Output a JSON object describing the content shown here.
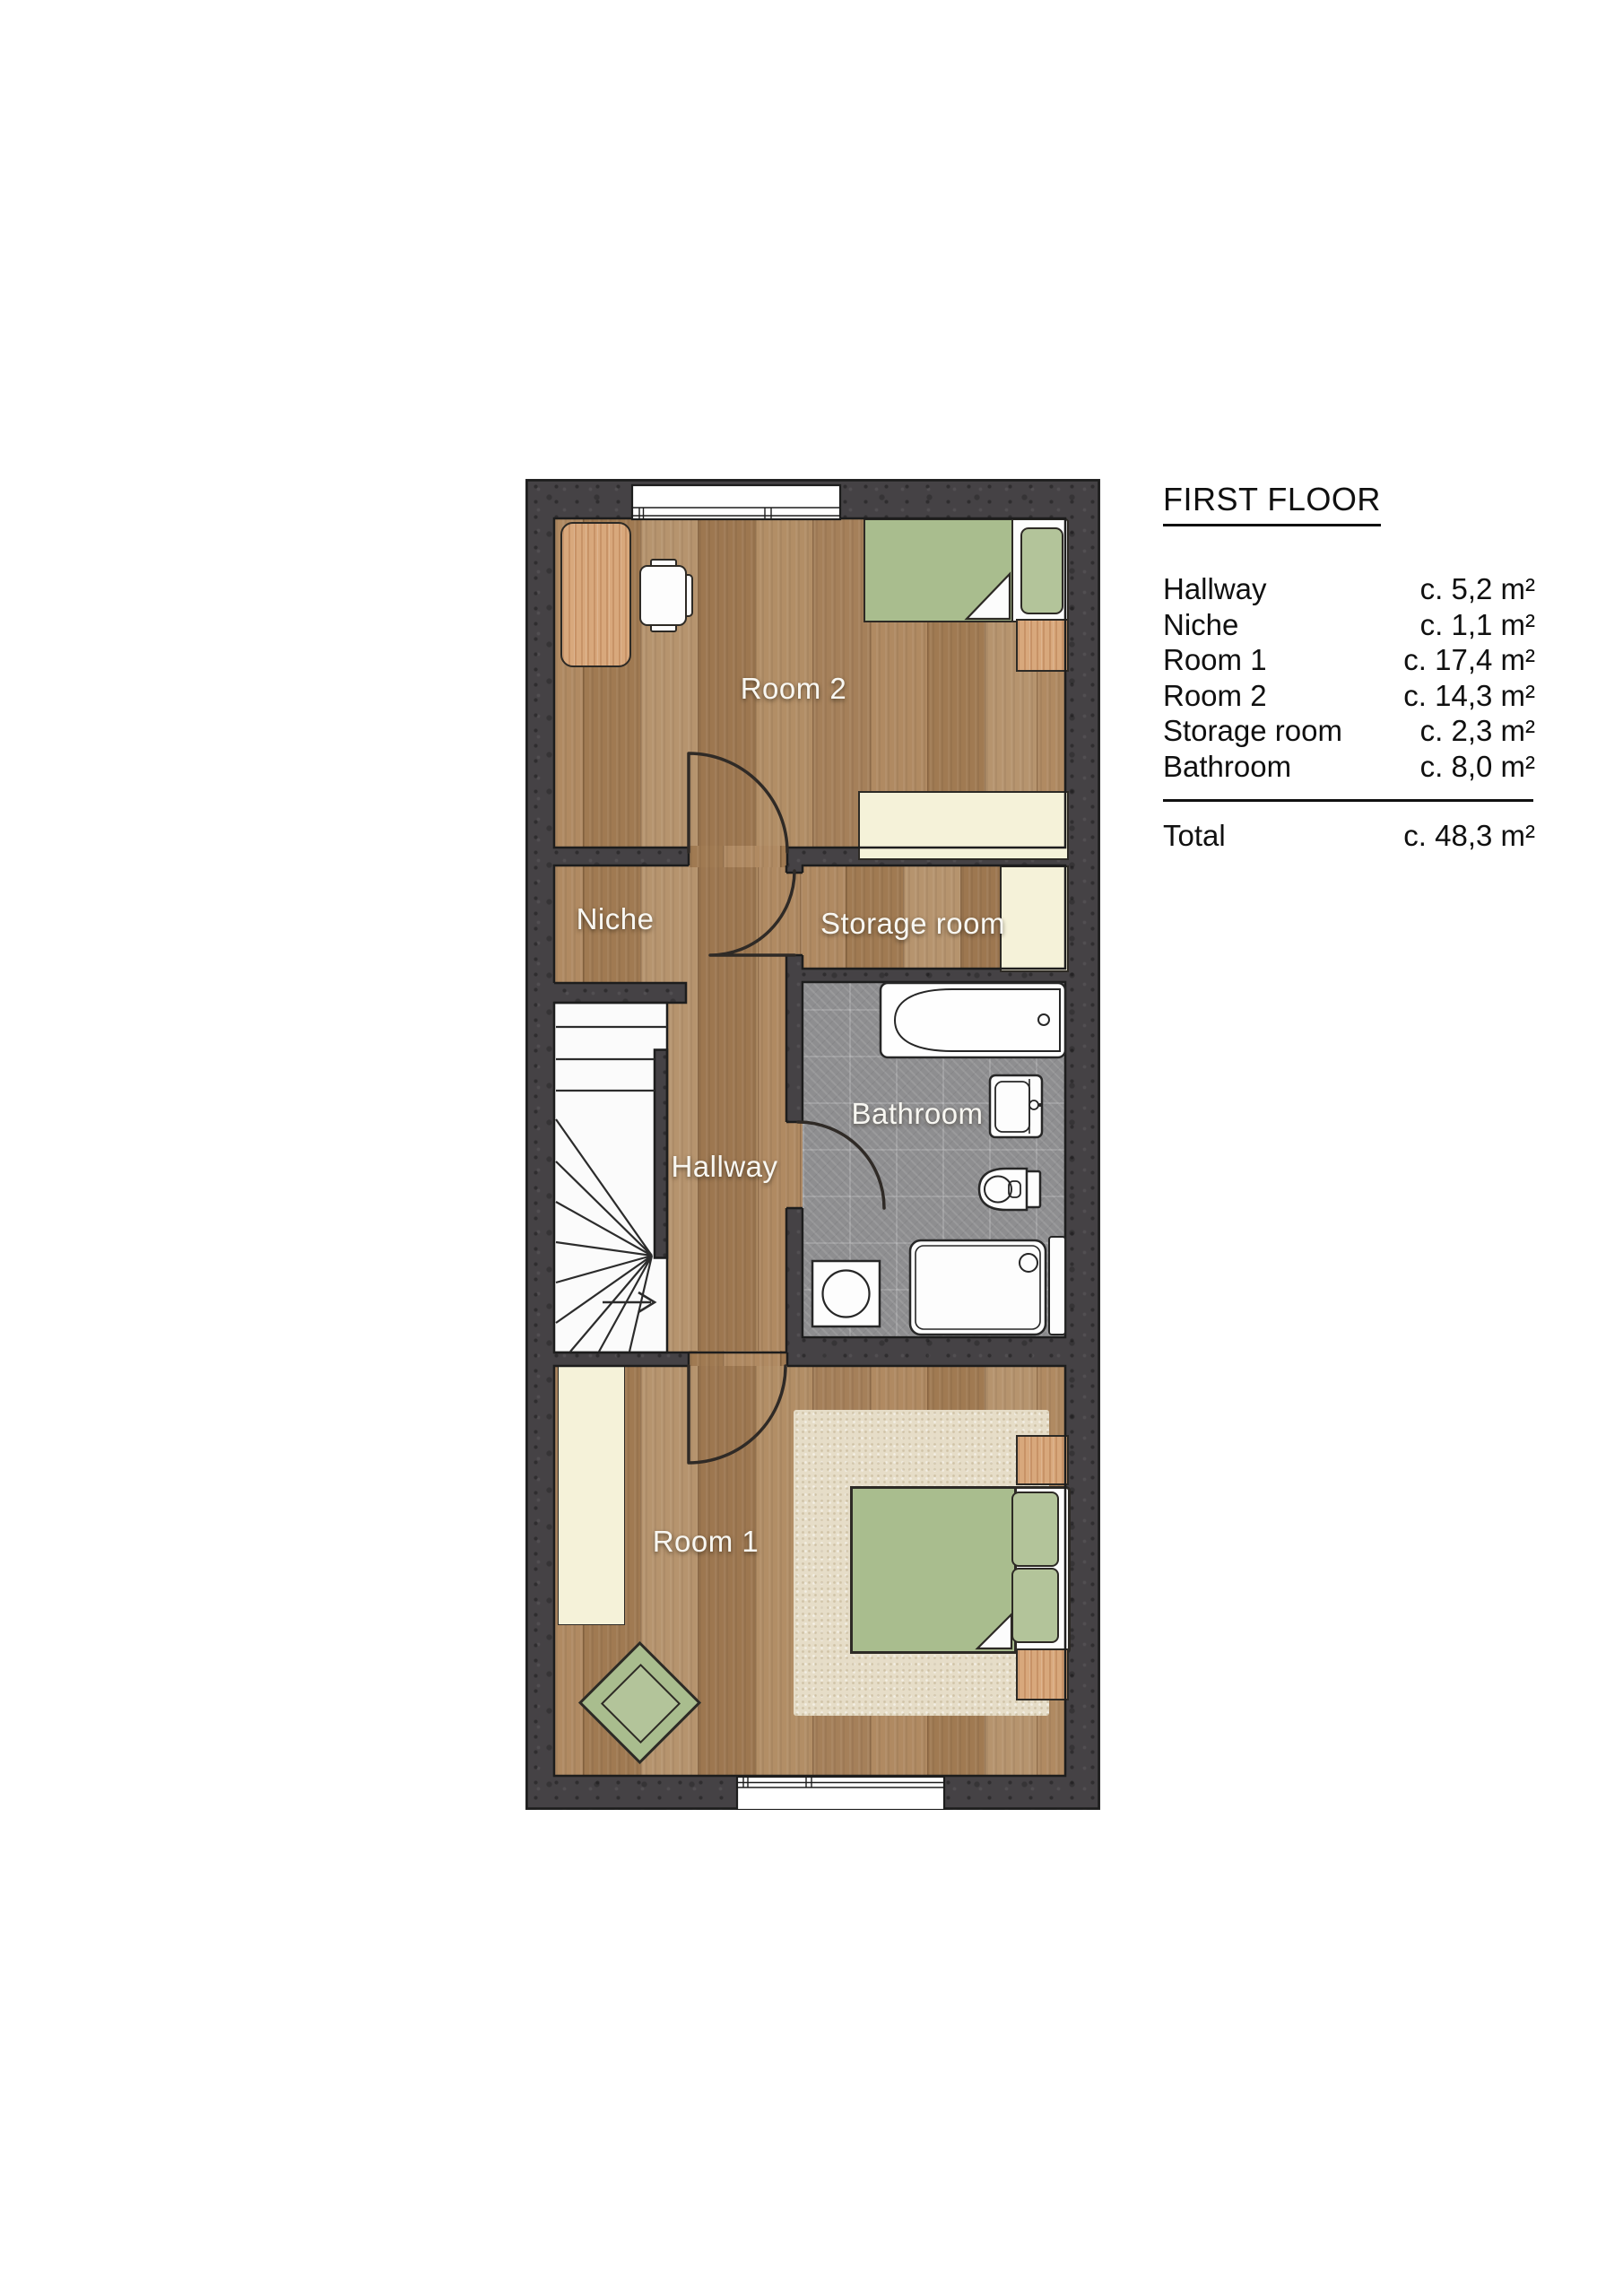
{
  "legend": {
    "title": "FIRST FLOOR",
    "rows": [
      {
        "name": "Hallway",
        "area": "c. 5,2 m²"
      },
      {
        "name": "Niche",
        "area": "c. 1,1 m²"
      },
      {
        "name": "Room 1",
        "area": "c. 17,4 m²"
      },
      {
        "name": "Room 2",
        "area": "c. 14,3 m²"
      },
      {
        "name": "Storage room",
        "area": "c. 2,3 m²"
      },
      {
        "name": "Bathroom",
        "area": "c. 8,0 m²"
      }
    ],
    "total": {
      "name": "Total",
      "area": "c. 48,3 m²"
    }
  },
  "plan": {
    "labels": {
      "room2": "Room 2",
      "niche": "Niche",
      "storage": "Storage room",
      "hallway": "Hallway",
      "bathroom": "Bathroom",
      "room1": "Room 1"
    }
  },
  "colors": {
    "wall": "#454245",
    "wood_floor": "#aa8660",
    "tile_floor": "#8e8e90",
    "furniture_wood": "#d8a87c",
    "bed_green": "#a9bd8e",
    "cream": "#f5f2d9",
    "rug": "#e6ddc8",
    "stairs_white": "#fbfbfb",
    "line": "#1d1d1d"
  }
}
